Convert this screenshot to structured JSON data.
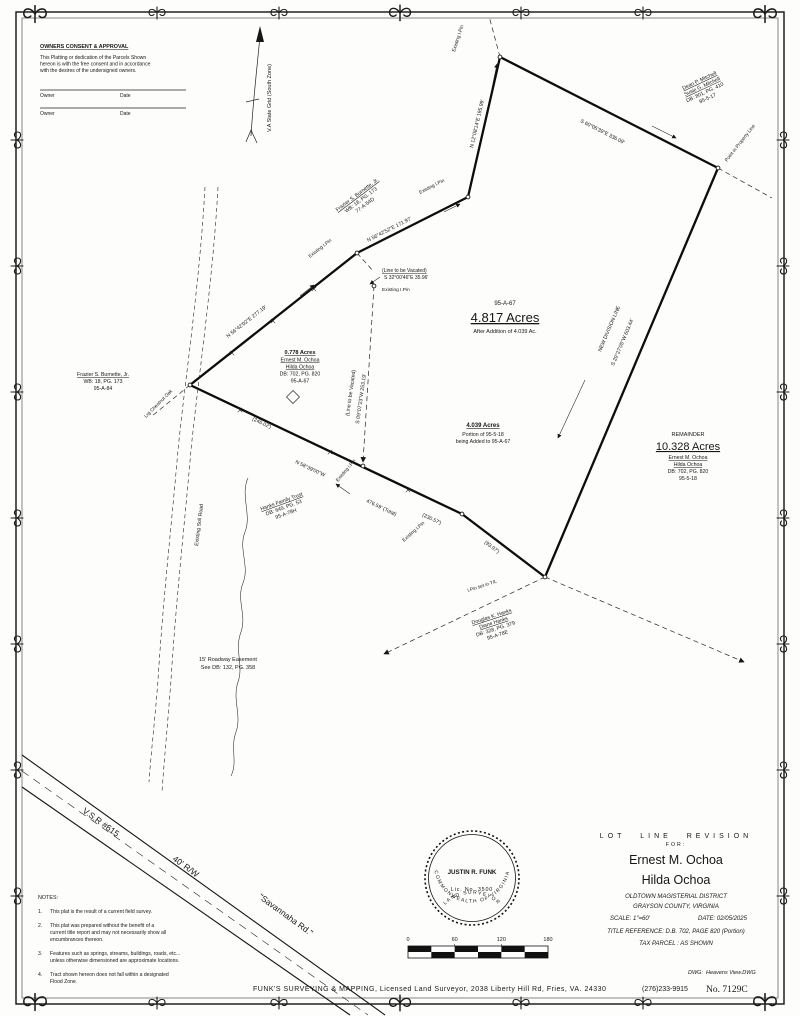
{
  "consent": {
    "title": "OWNERS CONSENT & APPROVAL",
    "body": [
      "This Platting or dedication of the Parcels Shown",
      "hereon is with the free consent and in accordance",
      "with the desires of the undersigned owners."
    ],
    "owner_label": "Owner",
    "date_label": "Date"
  },
  "north": {
    "label": "V.A State Grid (South Zone)"
  },
  "parcels": {
    "mitchell": {
      "l1": "Dean P. Mitchell",
      "l2": "Susie G. Mitchell",
      "l3": "DB: 801, PG. 410",
      "l4": "95-5-17"
    },
    "burnette_top": {
      "l1": "Frazier S. Burnette, Jr.",
      "l2": "WB: 18, PG. 173",
      "l3": "77-A-54D"
    },
    "burnette_left": {
      "l1": "Frazier S. Burnette, Jr.",
      "l2": "WB: 18, PG. 173",
      "l3": "95-A-84"
    },
    "ochoa_small": {
      "l1": "0.778 Acres",
      "l2": "Ernest M. Ochoa",
      "l3": "Hilda Ochoa",
      "l4": "DB: 702, PG. 820",
      "l5": "95-A-67"
    },
    "main": {
      "l1": "95-A-67",
      "l2": "4.817 Acres",
      "l3": "After Addition of 4.039 Ac."
    },
    "addition": {
      "l1": "4.039 Acres",
      "l2": "Portion of 95-5-18",
      "l3": "being Added to 95-A-67"
    },
    "remainder": {
      "l1": "REMAINDER",
      "l2": "10.328 Acres",
      "l3": "Ernest M. Ochoa",
      "l4": "Hilda Ochoa",
      "l5": "DB: 702, PG. 820",
      "l6": "95-5-18"
    },
    "hanks_family": {
      "l1": "Hanks Family Trust",
      "l2": "DB: 649, PG. 53",
      "l3": "95-A-78H"
    },
    "douglas_hanks": {
      "l1": "Douglas K. Hanks",
      "l2": "Diane Hanks",
      "l3": "DB: 328, PG. 379",
      "l4": "95-A-78E"
    }
  },
  "bearings": {
    "top_right": "S 60°05'39\"E  336.09'",
    "north_seg": "N 12°08'14\"E  195.99'",
    "mid_seg": "N 56°42'52\"E  171.97'",
    "west_seg": "N 56°42'02\"E  277.19'",
    "new_division_name": "NEW DIVISION LINE",
    "new_division": "S 29°27'05\"W  603.44'",
    "vacated_note": "(Line to be Vacated)",
    "vacated_short": "S 32°00'46\"E  35.96'",
    "vacated_long": "S 09°07'23\"W  253.19'",
    "south_bearing": "N 58°39'00\"W",
    "south_total": "476.59' (Total)",
    "south_part1": "(246.02')",
    "south_part2": "(230.57')",
    "south_part3": "(93.97')"
  },
  "pins": {
    "existing": "Existing I.Pin",
    "point_in_line": "Point in Property Line",
    "set_in_tl": "I.Pin set in T/L",
    "oak": "Lrg Chestnut Oak"
  },
  "easement": {
    "l1": "15' Roadway Easement",
    "l2": "See DB: 132, PG. 358"
  },
  "soil_road_label": "Existing Soil Road",
  "road": {
    "route": "V.S.R #615",
    "rw": "40' R/W",
    "name": "\"Savannaha Rd.\""
  },
  "notes": {
    "title": "NOTES:",
    "nums": [
      "1.",
      "2.",
      "3.",
      "4."
    ],
    "items": [
      [
        "This plat is the result of a current field survey."
      ],
      [
        "This plat was prepared without the benefit of a",
        "current title report and may not necessarily show all",
        "encumbrances thereon."
      ],
      [
        "Features such as springs, streams, buildings, roads, etc...",
        "unless otherwise dimensioned are approximate locations."
      ],
      [
        "Tract shown hereon does not fall within a designated",
        "Flood Zone."
      ]
    ]
  },
  "seal": {
    "arc_top": "COMMONWEALTH OF VIRGINIA",
    "name": "JUSTIN R. FUNK",
    "lic": "Lic. No. 3500",
    "arc_bottom": "LAND SURVEYOR"
  },
  "scale_bar": {
    "t0": "0",
    "t60": "60",
    "t120": "120",
    "t180": "180"
  },
  "title_block": {
    "title": "LOT LINE REVISION",
    "for_label": "FOR:",
    "name1": "Ernest M. Ochoa",
    "name2": "Hilda Ochoa",
    "district": "OLDTOWN MAGISTERIAL DISTRICT",
    "county": "GRAYSON COUNTY,  VIRGINIA",
    "scale": "SCALE:  1\"=60'",
    "date": "DATE: 02/05/2025",
    "title_ref": "TITLE REFERENCE:  D.B. 702,  PAGE 820 (Portion)",
    "tax": "TAX PARCEL :  AS SHOWN"
  },
  "footer": {
    "dwg_label": "DWG:",
    "dwg_value": "Heavens View.DWG",
    "firm": "FUNK'S SURVEYING & MAPPING, Licensed Land Surveyor, 2038 Liberty Hill Rd, Fries, VA. 24330",
    "phone": "(276)233-9915",
    "number": "No. 7129C"
  }
}
